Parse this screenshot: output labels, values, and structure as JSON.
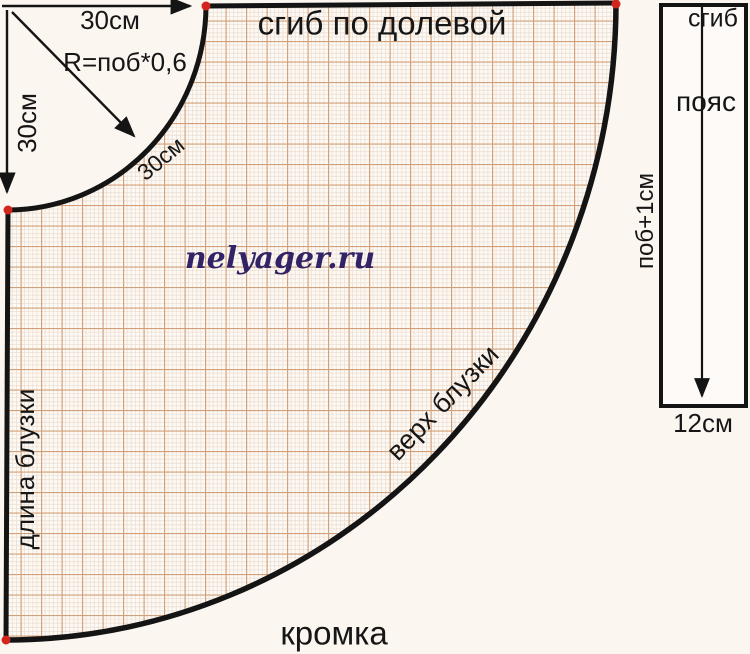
{
  "pattern": {
    "fold_grainline": "сгиб по долевой",
    "selvage": "кромка",
    "blouse_length": "длина блузки",
    "blouse_top": "верх блузки",
    "watermark": "nelyager.ru",
    "dimensions": {
      "top_width": "30см",
      "left_height": "30см",
      "radius_formula": "R=поб*0,6",
      "arc_radius": "30см"
    }
  },
  "waistband": {
    "fold": "сгиб",
    "label": "пояс",
    "width_formula": "поб+1см",
    "height": "12см"
  },
  "colors": {
    "outline": "#141414",
    "marker_dot": "#d2251d",
    "grid_major": "#d2a078",
    "grid_fine": "#eddfd4",
    "paper": "#fdfaf5",
    "background": "#fcf6f1",
    "watermark": "#322366"
  }
}
